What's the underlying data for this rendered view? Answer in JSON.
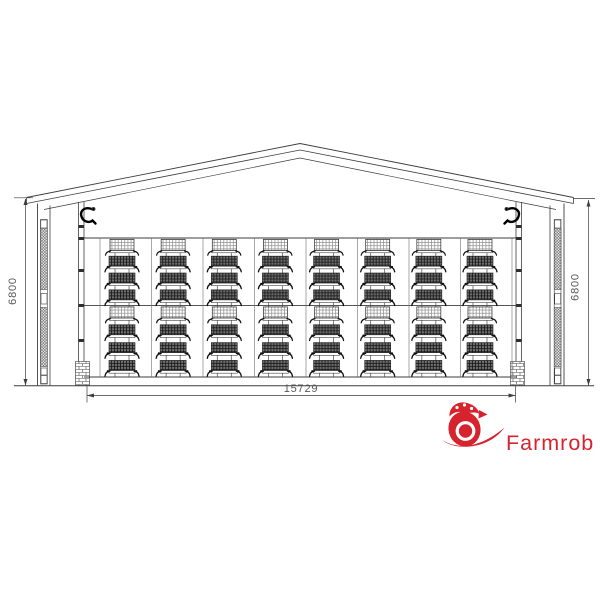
{
  "page": {
    "background_color": "#ffffff"
  },
  "drawing": {
    "line_color": "#3d3d3d",
    "dimensions": {
      "left_height_label": "6800",
      "right_height_label": "6800",
      "bottom_width_label": "15729"
    },
    "cage_layout": {
      "columns": 8,
      "tier_groups_per_column": 2,
      "tiers_per_group": 4
    }
  },
  "logo": {
    "text": "Farmrob",
    "color": "#d7232e",
    "icon": "hatching-egg-icon"
  }
}
